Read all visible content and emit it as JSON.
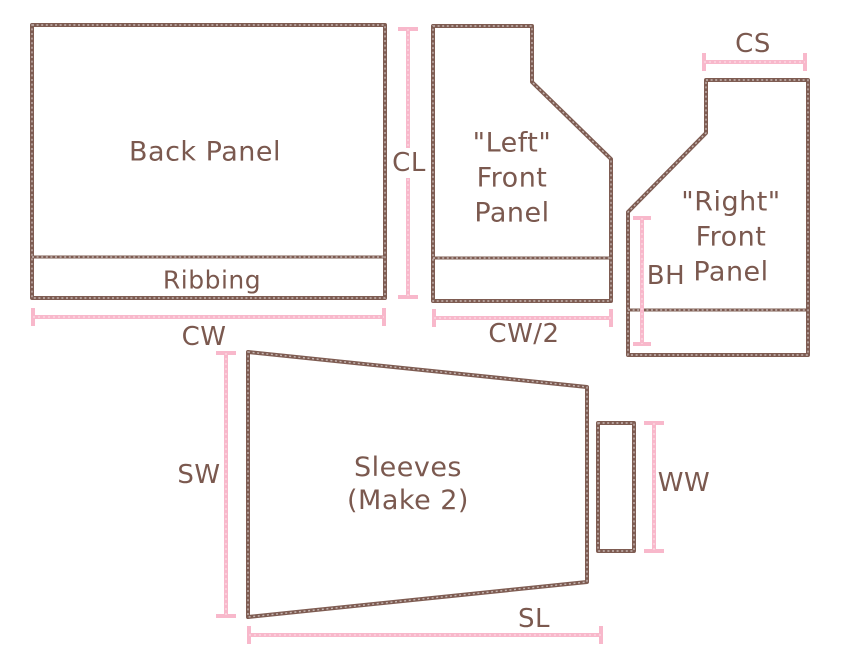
{
  "colors": {
    "outline": "#7e5c52",
    "text": "#7b594f",
    "dimension": "#f8b8cb"
  },
  "pieces": {
    "back_panel": {
      "label": "Back Panel",
      "ribbing": "Ribbing"
    },
    "left_front": {
      "lines": [
        "\"Left\"",
        "Front",
        "Panel"
      ]
    },
    "right_front": {
      "lines": [
        "\"Right\"",
        "Front",
        "Panel"
      ]
    },
    "sleeves": {
      "lines": [
        "Sleeves",
        "(Make 2)"
      ]
    }
  },
  "dimensions": {
    "cl": "CL",
    "cw": "CW",
    "cw_half": "CW/2",
    "cs": "CS",
    "bh": "BH",
    "sw": "SW",
    "ww": "WW",
    "sl": "SL"
  }
}
